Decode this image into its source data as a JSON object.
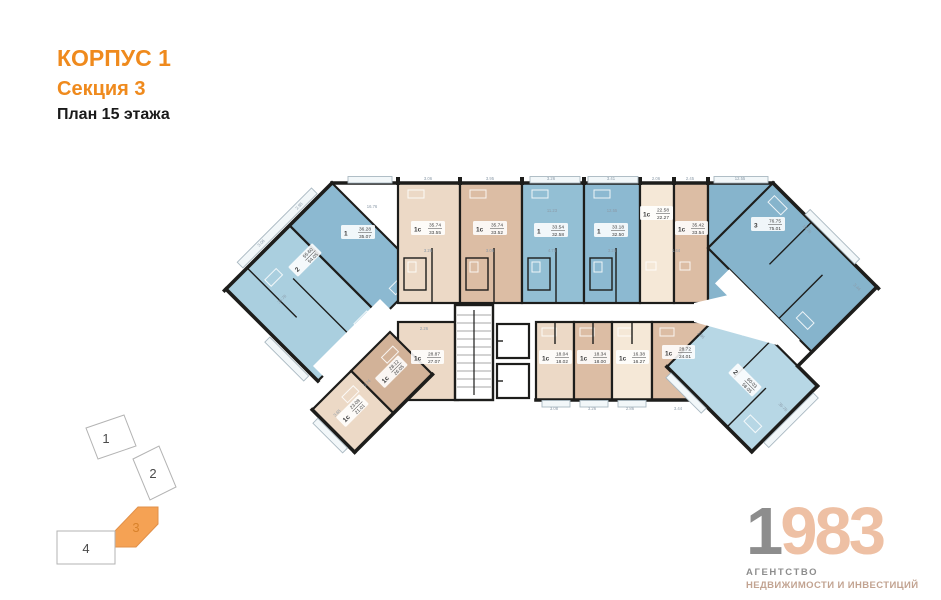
{
  "header": {
    "building": "КОРПУС 1",
    "section": "Секция 3",
    "plan": "План 15 этажа"
  },
  "colors": {
    "accent_orange": "#ef8a1d",
    "locator_active": "#f5a254",
    "apt_blue_mid": "#8cb9d1",
    "apt_blue_light": "#b7d7e5",
    "apt_beige": "#ecd9c6",
    "apt_tan": "#dcbda4",
    "apt_cream": "#f5e8d7",
    "wall": "#1d1d1b",
    "logo_gray": "#8d8d8d",
    "logo_peach": "#eec0a4"
  },
  "plan": {
    "apartments": [
      {
        "type": "1",
        "total": "36.28",
        "living": "35.07"
      },
      {
        "type": "2",
        "total": "55.60",
        "living": "54.05"
      },
      {
        "type": "1с",
        "total": "35.74",
        "living": "33.55"
      },
      {
        "type": "1с",
        "total": "35.74",
        "living": "33.52"
      },
      {
        "type": "1",
        "total": "33.54",
        "living": "32.58"
      },
      {
        "type": "1",
        "total": "33.18",
        "living": "32.50"
      },
      {
        "type": "1с",
        "total": "22.58",
        "living": "22.27"
      },
      {
        "type": "1с",
        "total": "35.42",
        "living": "33.54"
      },
      {
        "type": "3",
        "total": "76.75",
        "living": "75.01"
      },
      {
        "type": "2",
        "total": "60.03",
        "living": "58.05"
      },
      {
        "type": "1с",
        "total": "23.08",
        "living": "21.01"
      },
      {
        "type": "1с",
        "total": "28.12",
        "living": "26.05"
      },
      {
        "type": "1с",
        "total": "28.87",
        "living": "27.07"
      },
      {
        "type": "1с",
        "total": "18.04",
        "living": "18.02"
      },
      {
        "type": "1с",
        "total": "18.34",
        "living": "18.00"
      },
      {
        "type": "1с",
        "total": "16.38",
        "living": "16.27"
      },
      {
        "type": "1с",
        "total": "28.72",
        "living": "24.01"
      }
    ],
    "dimensions": [
      {
        "t": "3.06",
        "x": 428,
        "y": 180
      },
      {
        "t": "3.95",
        "x": 490,
        "y": 180
      },
      {
        "t": "3.26",
        "x": 551,
        "y": 180
      },
      {
        "t": "3.41",
        "x": 611,
        "y": 180
      },
      {
        "t": "2.06",
        "x": 656,
        "y": 180
      },
      {
        "t": "2.45",
        "x": 690,
        "y": 180
      },
      {
        "t": "12.55",
        "x": 740,
        "y": 180
      },
      {
        "t": "11.23",
        "x": 552,
        "y": 212
      },
      {
        "t": "12.55",
        "x": 612,
        "y": 212
      },
      {
        "t": "16.76",
        "x": 372,
        "y": 208
      },
      {
        "t": "3.26",
        "x": 428,
        "y": 252
      },
      {
        "t": "3.06",
        "x": 490,
        "y": 252
      },
      {
        "t": "4.75",
        "x": 552,
        "y": 252
      },
      {
        "t": "3.26",
        "x": 612,
        "y": 252
      },
      {
        "t": "1.44",
        "x": 676,
        "y": 252
      },
      {
        "t": "2.95",
        "x": 300,
        "y": 207,
        "r": -45
      },
      {
        "t": "3.06",
        "x": 262,
        "y": 244,
        "r": -45
      },
      {
        "t": "35.76",
        "x": 283,
        "y": 300,
        "r": -45
      },
      {
        "t": "16.76",
        "x": 806,
        "y": 230,
        "r": 45
      },
      {
        "t": "3.44",
        "x": 856,
        "y": 288,
        "r": 45
      },
      {
        "t": "35.76",
        "x": 782,
        "y": 408,
        "r": 45
      },
      {
        "t": "2.86",
        "x": 700,
        "y": 336,
        "r": 45
      },
      {
        "t": "3.08",
        "x": 554,
        "y": 410
      },
      {
        "t": "3.26",
        "x": 592,
        "y": 410
      },
      {
        "t": "2.86",
        "x": 630,
        "y": 410
      },
      {
        "t": "3.44",
        "x": 678,
        "y": 410
      },
      {
        "t": "2.26",
        "x": 424,
        "y": 330
      },
      {
        "t": "2.74",
        "x": 368,
        "y": 384,
        "r": -45
      },
      {
        "t": "3.65",
        "x": 338,
        "y": 414,
        "r": -45
      }
    ]
  },
  "locator": {
    "sections": [
      {
        "label": "1",
        "active": false
      },
      {
        "label": "2",
        "active": false
      },
      {
        "label": "3",
        "active": true
      },
      {
        "label": "4",
        "active": false
      }
    ]
  },
  "logo": {
    "year_first": "1",
    "year_rest": "983",
    "line1": "АГЕНТСТВО",
    "line2": "НЕДВИЖИМОСТИ И ИНВЕСТИЦИЙ"
  }
}
